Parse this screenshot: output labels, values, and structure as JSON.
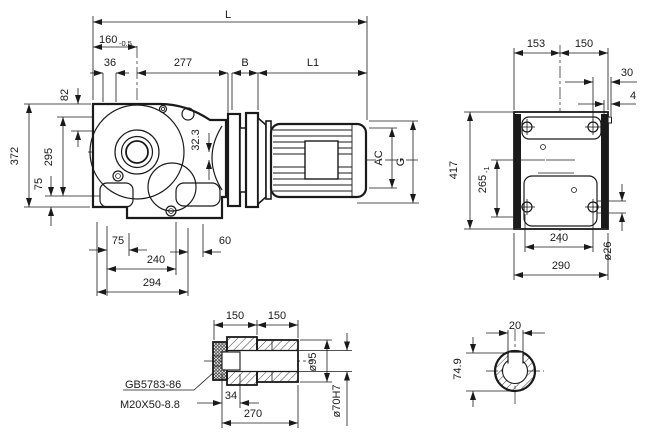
{
  "drawing": {
    "ink_color": "#1a1a1a",
    "paper_color": "#ffffff",
    "side_view": {
      "dim_L": "L",
      "dim_160": "160",
      "dim_160_tol": "-0.5",
      "dim_36": "36",
      "dim_277": "277",
      "dim_B": "B",
      "dim_L1": "L1",
      "dim_82": "82",
      "dim_372": "372",
      "dim_295": "295",
      "dim_75_left": "75",
      "dim_32_3": "32.3",
      "dim_AC": "AC",
      "dim_G": "G",
      "dim_75_bottom": "75",
      "dim_240": "240",
      "dim_294": "294",
      "dim_60": "60"
    },
    "end_view": {
      "dim_153": "153",
      "dim_150": "150",
      "dim_30": "30",
      "dim_4": "4",
      "dim_417": "417",
      "dim_265": "265",
      "dim_265_tol": "-1",
      "dim_240": "240",
      "dim_290": "290",
      "dim_dia26": "ø26"
    },
    "shaft_view": {
      "dim_150_left": "150",
      "dim_150_right": "150",
      "note_standard": "GB5783-86",
      "note_bolt": "M20X50-8.8",
      "dim_34": "34",
      "dim_270": "270",
      "dim_dia95": "ø95",
      "dim_dia70": "ø70H7"
    },
    "section_view": {
      "dim_20": "20",
      "dim_74_9": "74.9"
    }
  }
}
